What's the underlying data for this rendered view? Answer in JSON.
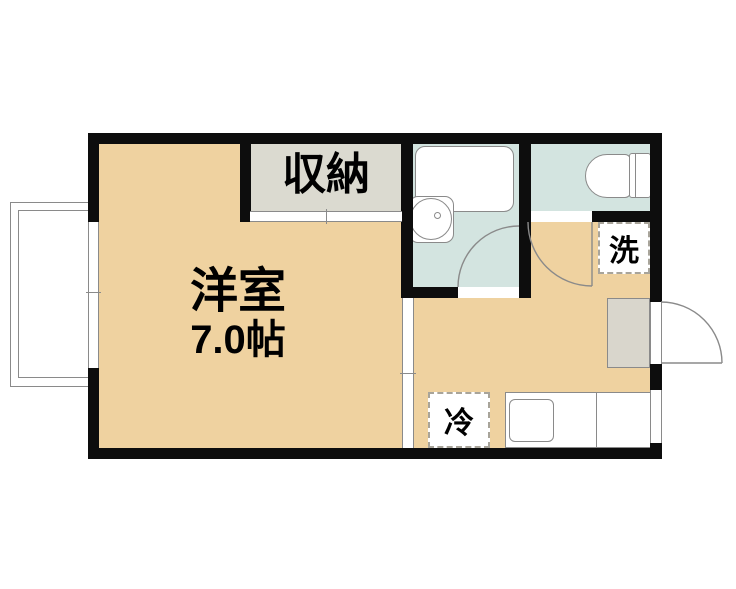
{
  "plan": {
    "type": "apartment-floor-plan",
    "rooms": {
      "western_room": {
        "name": "洋室",
        "area": "7.0帖"
      },
      "closet": {
        "label": "収納"
      },
      "bathroom": {
        "label": ""
      },
      "toilet_room": {
        "label": ""
      },
      "kitchen_hall": {
        "label": ""
      }
    },
    "equipment": {
      "washer_space": {
        "label": "洗"
      },
      "fridge_space": {
        "label": "冷"
      }
    },
    "features": [
      "balcony",
      "window",
      "sliding-door",
      "bathtub",
      "wash-basin",
      "toilet",
      "kitchen-counter",
      "kitchen-sink",
      "entrance-step",
      "entry-door-swing",
      "toilet-door-swing",
      "bathroom-door-swing"
    ],
    "colors": {
      "wall": "#0d0d0d",
      "floor": "#efd2a0",
      "closet": "#dbdad0",
      "wet": "#d3e4e0",
      "genkan": "#d9d6cc",
      "line": "#8a8a8a",
      "dash": "#a8a49a"
    }
  }
}
